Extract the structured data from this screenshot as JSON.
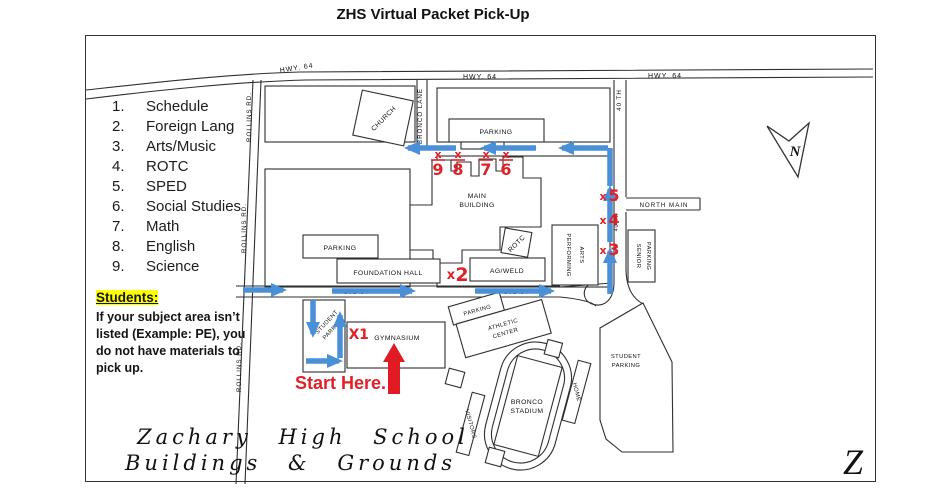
{
  "title": "ZHS Virtual Packet Pick-Up",
  "legend": {
    "items": [
      {
        "num": "1.",
        "label": "Schedule"
      },
      {
        "num": "2.",
        "label": "Foreign Lang"
      },
      {
        "num": "3.",
        "label": "Arts/Music"
      },
      {
        "num": "4.",
        "label": "ROTC"
      },
      {
        "num": "5.",
        "label": "SPED"
      },
      {
        "num": "6.",
        "label": "Social Studies"
      },
      {
        "num": "7.",
        "label": "Math"
      },
      {
        "num": "8.",
        "label": "English"
      },
      {
        "num": "9.",
        "label": "Science"
      }
    ]
  },
  "note": {
    "heading": "Students:",
    "line1": "If your subject area isn’t",
    "line2": "listed (Example: PE), you",
    "line3": "do not have materials to",
    "line4": "pick up."
  },
  "route": {
    "start_label": "Start Here."
  },
  "map": {
    "roads": {
      "hwy64": "HWY. 64",
      "rollins": "ROLLINS RD.",
      "bronco_lane": "BRONCO LANE",
      "fortieth": "40 TH",
      "north_main": "NORTH MAIN",
      "st101": "101 ST"
    },
    "buildings": {
      "church": "CHURCH",
      "parking": "PARKING",
      "main1": "MAIN",
      "main2": "BUILDING",
      "rotc": "ROTC",
      "performing1": "PERFORMING",
      "performing2": "ARTS",
      "foundation": "FOUNDATION HALL",
      "agweld": "AG/WELD",
      "senior1": "SENIOR",
      "senior2": "PARKING",
      "student1": "STUDENT",
      "student2": "PARKING",
      "gym": "GYMNASIUM",
      "athletic1": "ATHLETIC",
      "athletic2": "CENTER",
      "stadium1": "BRONCO",
      "stadium2": "STADIUM",
      "home": "HOME",
      "visitors": "VISITORS"
    },
    "markers": {
      "top": [
        {
          "prefix": "x",
          "num": "9"
        },
        {
          "prefix": "x",
          "num": "8"
        },
        {
          "prefix": "x",
          "num": "7"
        },
        {
          "prefix": "x",
          "num": "6"
        }
      ],
      "side": [
        {
          "prefix": "x",
          "num": "5"
        },
        {
          "prefix": "x",
          "num": "4"
        },
        {
          "prefix": "x",
          "num": "3"
        }
      ],
      "foundation": {
        "prefix": "x",
        "num": "2"
      },
      "gym": {
        "prefix": "X",
        "num": "1"
      }
    },
    "compass": "N",
    "corner_mark": "Z",
    "footer1": "Zachary High School",
    "footer2": "Buildings & Grounds"
  },
  "colors": {
    "route_blue": "#4a90d8",
    "marker_red": "#e02128",
    "highlight_yellow": "#ffff00",
    "ink": "#2f2f2f"
  }
}
